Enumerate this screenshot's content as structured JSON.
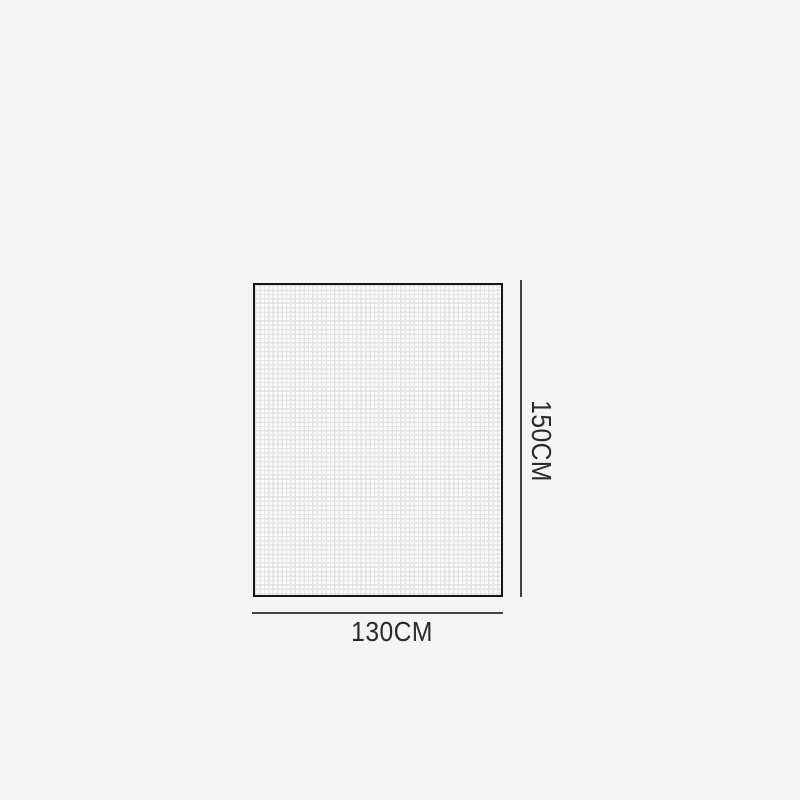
{
  "figure": {
    "type": "product-dimension-diagram",
    "height_label": "150CM",
    "width_label": "130CM"
  },
  "colors": {
    "background": "#f4f4f5",
    "swatch_border": "#151515",
    "swatch_fill": "#fcfcfc",
    "mesh_grid_line": "#e3e3e3",
    "dimension_line": "#414141",
    "label_text": "#2b2b2b"
  }
}
